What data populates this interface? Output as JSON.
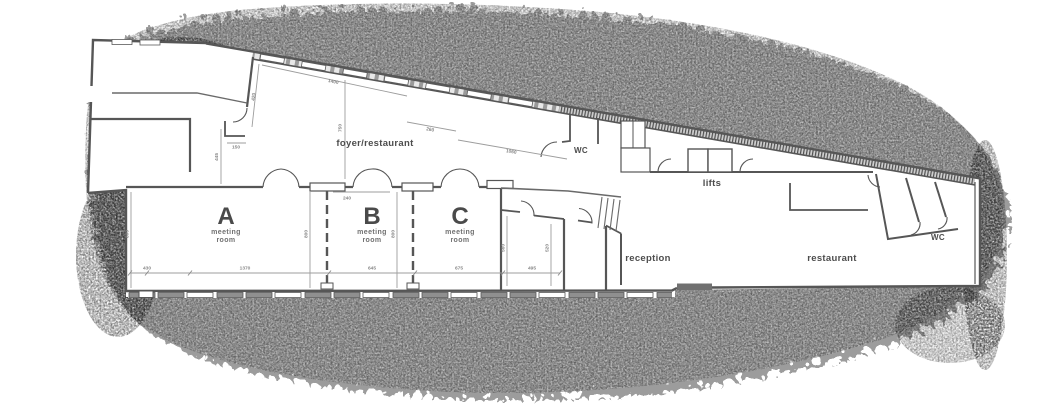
{
  "plan": {
    "rooms": {
      "a": {
        "letter": "A",
        "type_line1": "meeting",
        "type_line2": "room"
      },
      "b": {
        "letter": "B",
        "type_line1": "meeting",
        "type_line2": "room"
      },
      "c": {
        "letter": "C",
        "type_line1": "meeting",
        "type_line2": "room"
      }
    },
    "labels": {
      "foyer": "foyer/restaurant",
      "wc_upper": "WC",
      "lifts": "lifts",
      "reception": "reception",
      "restaurant": "restaurant",
      "wc_right": "WC"
    },
    "dims": {
      "upper_left_wall": "420",
      "foyer_glazing": "1400",
      "foyer_depth": "750",
      "vestibule": "260",
      "foyer_front": "1060",
      "nook_width": "150",
      "nook_depth": "445",
      "partition_offset": "240",
      "room_a_left_height": "800",
      "room_a_right_height": "800",
      "room_b_right_height": "800",
      "room_d_left_height": "560",
      "room_d_right_height": "520",
      "bottom_1": "430",
      "bottom_2": "1370",
      "bottom_3": "645",
      "bottom_4": "675",
      "bottom_5": "495"
    },
    "colors": {
      "wall": "#565656",
      "dimension": "#9d9d9d",
      "label_text": "#4d4d4d",
      "noise": "#909090"
    }
  }
}
